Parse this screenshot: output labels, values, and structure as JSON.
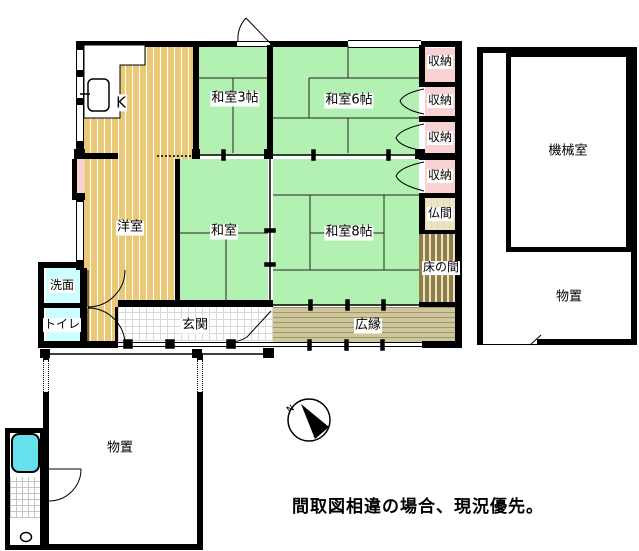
{
  "note": "間取図相違の場合、現況優先。",
  "compass": {
    "north_label": "N"
  },
  "rooms": {
    "kitchen": "K",
    "washitsu_3": "和室3帖",
    "washitsu_6": "和室6帖",
    "storage": [
      "収納",
      "収納",
      "収納",
      "収納"
    ],
    "butsuma": "仏間",
    "tokonoma": "床の間",
    "youshitsu": "洋室",
    "washitsu": "和室",
    "washitsu_8": "和室8帖",
    "senmen": "洗面",
    "toilet": "トイレ",
    "genkan": "玄関",
    "hiroen": "広縁",
    "machine_room": "機械室",
    "storage_right": "物置",
    "storage_lower": "物置"
  },
  "colors": {
    "tatami_green": "#b3f1b3",
    "wood_tan": "#e9c877",
    "closet_pink": "#f8d2d2",
    "wet_area_cyan": "#ccffff",
    "bathtub_cyan": "#66e0ea",
    "veranda_tan": "#cfc79a",
    "tokonoma_olive": "#8f7e49",
    "wall_black": "#000000"
  }
}
